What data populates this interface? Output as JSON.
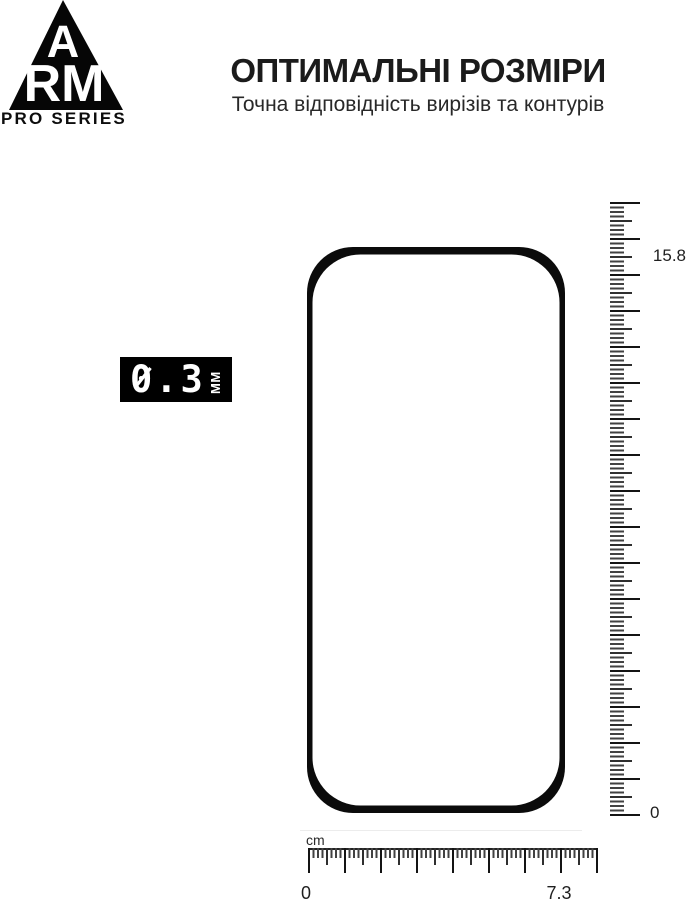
{
  "brand": {
    "monogram_top": "A",
    "monogram_bottom": "RM",
    "series": "PRO SERIES"
  },
  "header": {
    "title": "ОПТИМАЛЬНІ РОЗМІРИ",
    "subtitle": "Точна відповідність вирізів та контурів"
  },
  "thickness_badge": {
    "value": "0.3",
    "unit": "ММ"
  },
  "rulers": {
    "vertical": {
      "max_label": "15.8",
      "min_label": "0"
    },
    "horizontal": {
      "unit_label": "cm",
      "start_label": "0",
      "end_label": "7.3"
    }
  },
  "colors": {
    "ink": "#141414",
    "badge_background": "#000000",
    "badge_text": "#ffffff",
    "tick_short": "#424242",
    "tick_medium": "#2f2f2f",
    "tick_major": "#141414",
    "background": "#ffffff"
  }
}
